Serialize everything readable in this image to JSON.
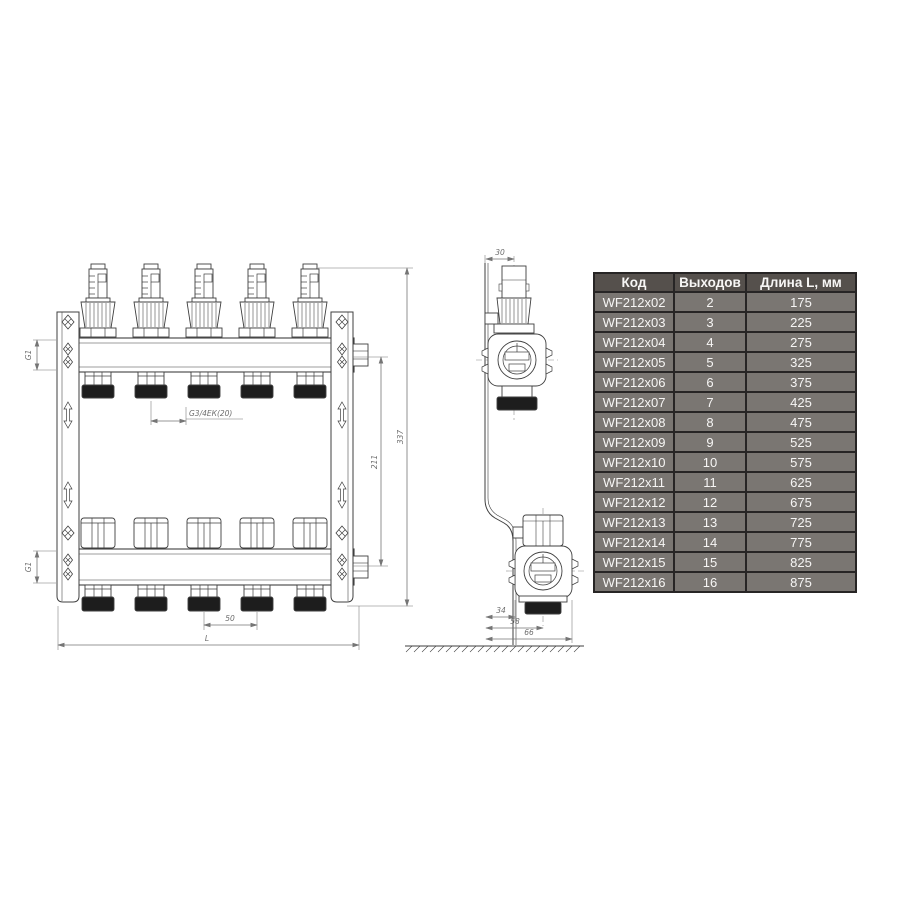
{
  "drawing": {
    "labels": {
      "g1_top": "G1",
      "g1_bottom": "G1",
      "outlet_thread": "G3/4ЕК(20)",
      "outlet_spacing": "50",
      "total_length": "L",
      "height_inner": "211",
      "height_overall": "337",
      "top_offset": "30",
      "depth_bracket": "34",
      "depth_axis": "58",
      "depth_overall": "66"
    },
    "line_color": "#3f3f3f",
    "dim_color": "#757575"
  },
  "table": {
    "headers": [
      "Код",
      "Выходов",
      "Длина L, мм"
    ],
    "header_bg": "#55504c",
    "row_bg": "#7a7672",
    "border_color": "#272525",
    "text_color": "#f7f6f5",
    "rows": [
      {
        "code": "WF212x02",
        "outputs": "2",
        "length": "175"
      },
      {
        "code": "WF212x03",
        "outputs": "3",
        "length": "225"
      },
      {
        "code": "WF212x04",
        "outputs": "4",
        "length": "275"
      },
      {
        "code": "WF212x05",
        "outputs": "5",
        "length": "325"
      },
      {
        "code": "WF212x06",
        "outputs": "6",
        "length": "375"
      },
      {
        "code": "WF212x07",
        "outputs": "7",
        "length": "425"
      },
      {
        "code": "WF212x08",
        "outputs": "8",
        "length": "475"
      },
      {
        "code": "WF212x09",
        "outputs": "9",
        "length": "525"
      },
      {
        "code": "WF212x10",
        "outputs": "10",
        "length": "575"
      },
      {
        "code": "WF212x11",
        "outputs": "11",
        "length": "625"
      },
      {
        "code": "WF212x12",
        "outputs": "12",
        "length": "675"
      },
      {
        "code": "WF212x13",
        "outputs": "13",
        "length": "725"
      },
      {
        "code": "WF212x14",
        "outputs": "14",
        "length": "775"
      },
      {
        "code": "WF212x15",
        "outputs": "15",
        "length": "825"
      },
      {
        "code": "WF212x16",
        "outputs": "16",
        "length": "875"
      }
    ]
  }
}
